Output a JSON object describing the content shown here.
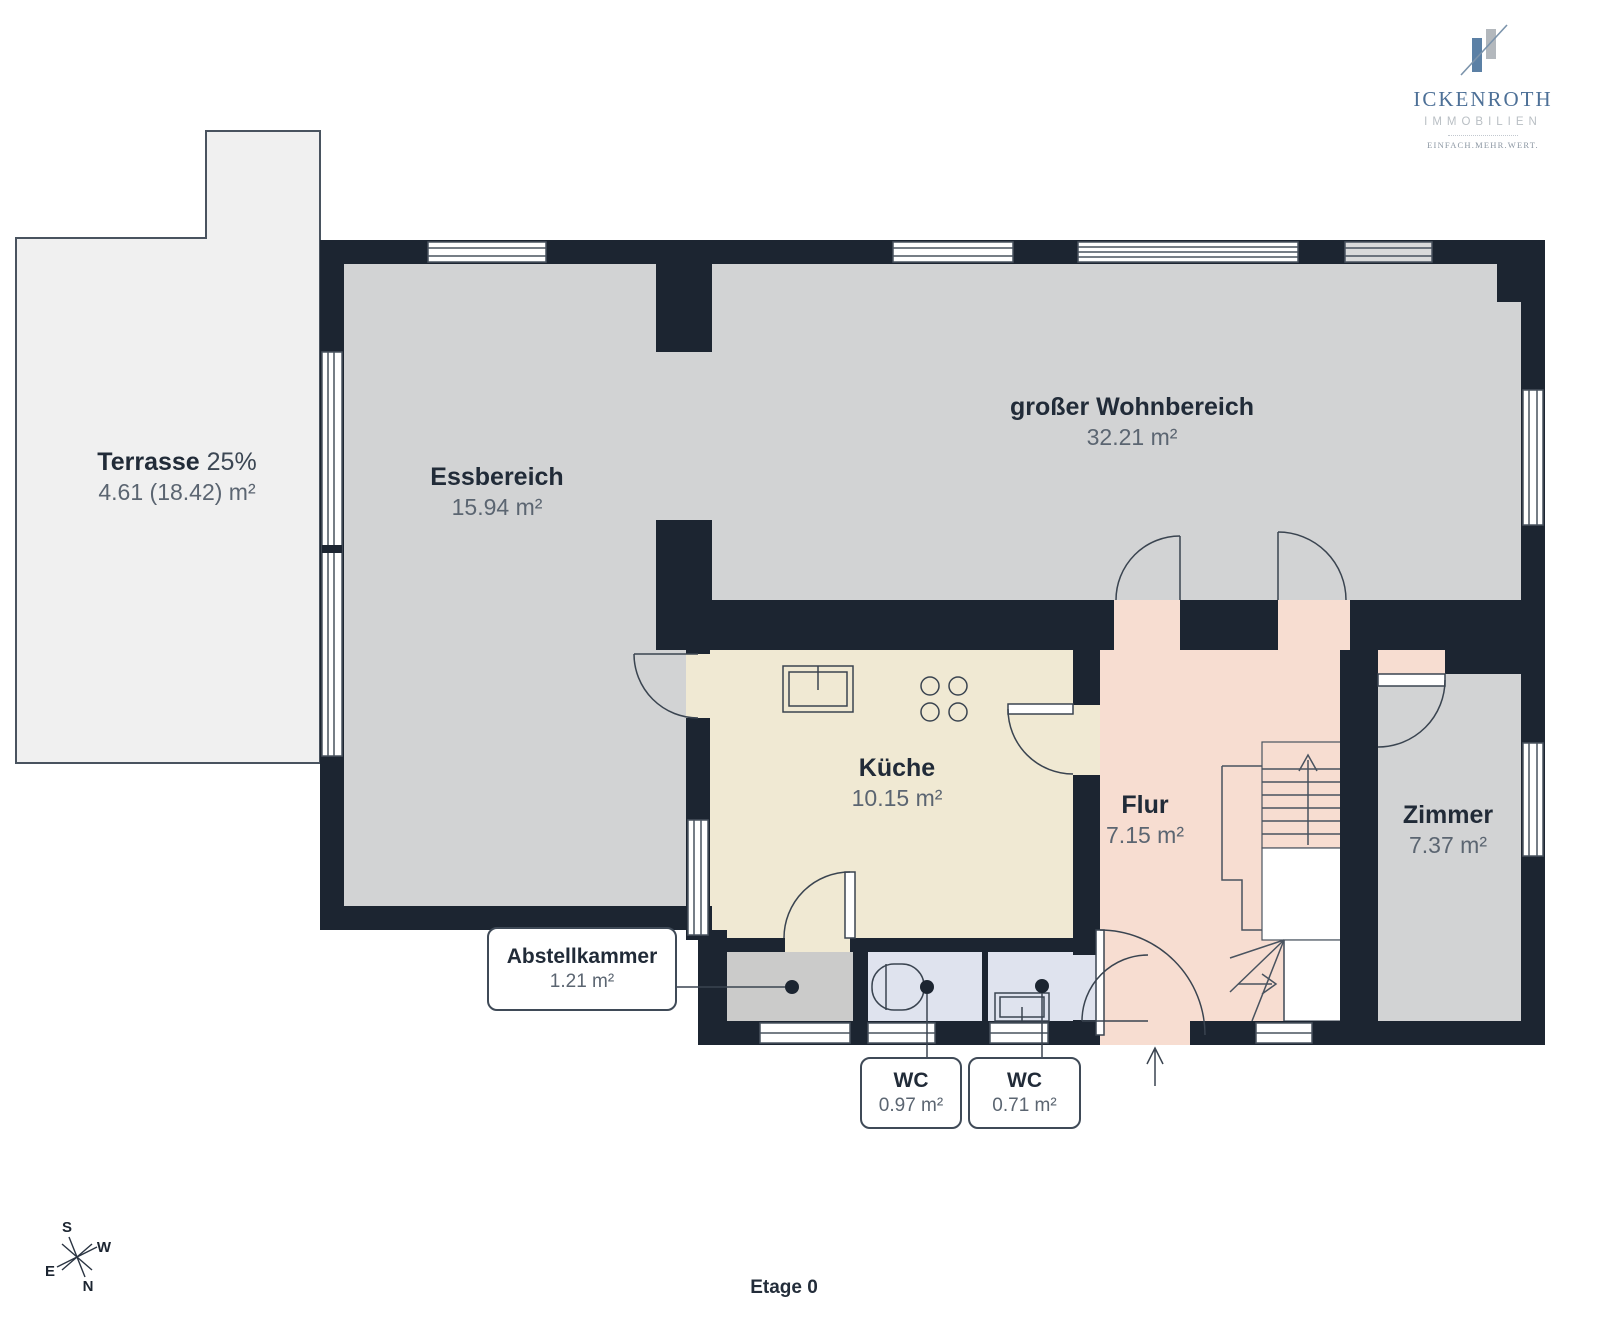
{
  "brand": {
    "name": "ICKENROTH",
    "subtitle": "IMMOBILIEN",
    "tagline": "EINFACH.MEHR.WERT."
  },
  "floor_label": "Etage 0",
  "compass": {
    "n": "N",
    "e": "E",
    "s": "S",
    "w": "W"
  },
  "rooms": [
    {
      "id": "terrasse",
      "name": "Terrasse",
      "factor": "25%",
      "area": "4.61 (18.42) m²"
    },
    {
      "id": "essbereich",
      "name": "Essbereich",
      "area": "15.94 m²"
    },
    {
      "id": "wohnbereich",
      "name": "großer Wohnbereich",
      "area": "32.21 m²"
    },
    {
      "id": "kueche",
      "name": "Küche",
      "area": "10.15 m²"
    },
    {
      "id": "flur",
      "name": "Flur",
      "area": "7.15 m²"
    },
    {
      "id": "zimmer",
      "name": "Zimmer",
      "area": "7.37 m²"
    },
    {
      "id": "abstellkammer",
      "name": "Abstellkammer",
      "area": "1.21 m²"
    },
    {
      "id": "wc-links",
      "name": "WC",
      "area": "0.97 m²"
    },
    {
      "id": "wc-rechts",
      "name": "WC",
      "area": "0.71 m²"
    }
  ],
  "colors": {
    "wall": "#1c2531",
    "living_gray": "#d2d3d4",
    "terrace": "#f0f0f0",
    "kitchen": "#f0e9d3",
    "hallway": "#f7ddd1",
    "wc": "#dfe3ee",
    "storage": "#cbcbca",
    "brand_blue": "#54779e"
  }
}
